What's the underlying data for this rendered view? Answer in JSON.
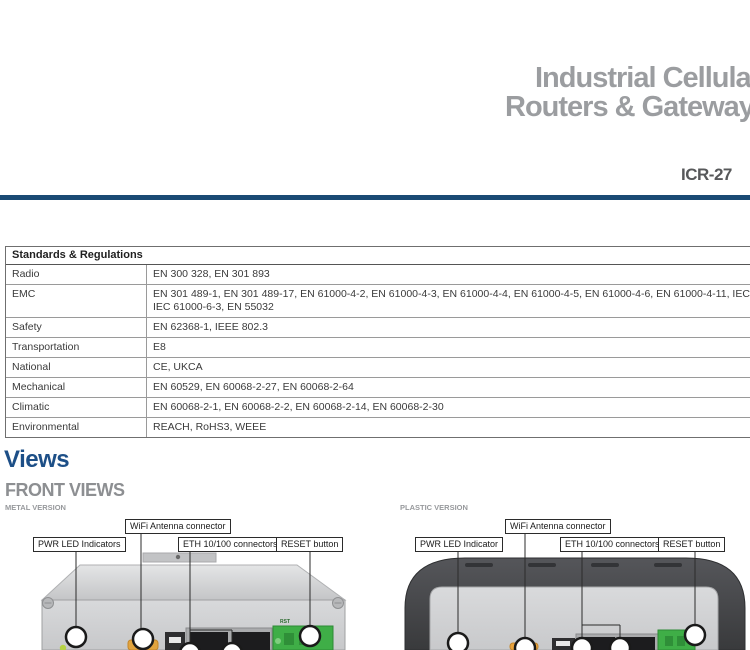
{
  "header": {
    "title_line1": "Industrial Cellular",
    "title_line2": "Routers & Gateways",
    "model": "ICR-27",
    "accent_color": "#1a4a74",
    "title_color": "#9b9da0"
  },
  "table": {
    "header": "Standards & Regulations",
    "rows": [
      {
        "label": "Radio",
        "value": "EN 300 328, EN 301 893"
      },
      {
        "label": "EMC",
        "value": "EN 301 489-1, EN 301 489-17, EN 61000-4-2, EN 61000-4-3, EN 61000-4-4, EN 61000-4-5, EN 61000-4-6, EN 61000-4-11, IEC 61000-6-2,\nIEC 61000-6-3, EN 55032"
      },
      {
        "label": "Safety",
        "value": "EN 62368-1, IEEE 802.3"
      },
      {
        "label": "Transportation",
        "value": "E8"
      },
      {
        "label": "National",
        "value": "CE, UKCA"
      },
      {
        "label": "Mechanical",
        "value": "EN 60529, EN 60068-2-27, EN 60068-2-64"
      },
      {
        "label": "Climatic",
        "value": "EN 60068-2-1, EN 60068-2-2, EN 60068-2-14, EN 60068-2-30"
      },
      {
        "label": "Environmental",
        "value": "REACH, RoHS3, WEEE"
      }
    ]
  },
  "views": {
    "section_title": "Views",
    "subsection_title": "FRONT VIEWS",
    "metal": {
      "variant_label": "METAL VERSION",
      "labels": {
        "wifi": "WiFi Antenna connector",
        "pwr": "PWR LED Indicators",
        "eth": "ETH 10/100 connectors",
        "reset": "RESET button"
      },
      "rst_marking": "RST"
    },
    "plastic": {
      "variant_label": "PLASTIC VERSION",
      "labels": {
        "wifi": "WiFi Antenna connector",
        "pwr": "PWR LED Indicator",
        "eth": "ETH 10/100 connectors",
        "reset": "RESET button"
      }
    }
  }
}
